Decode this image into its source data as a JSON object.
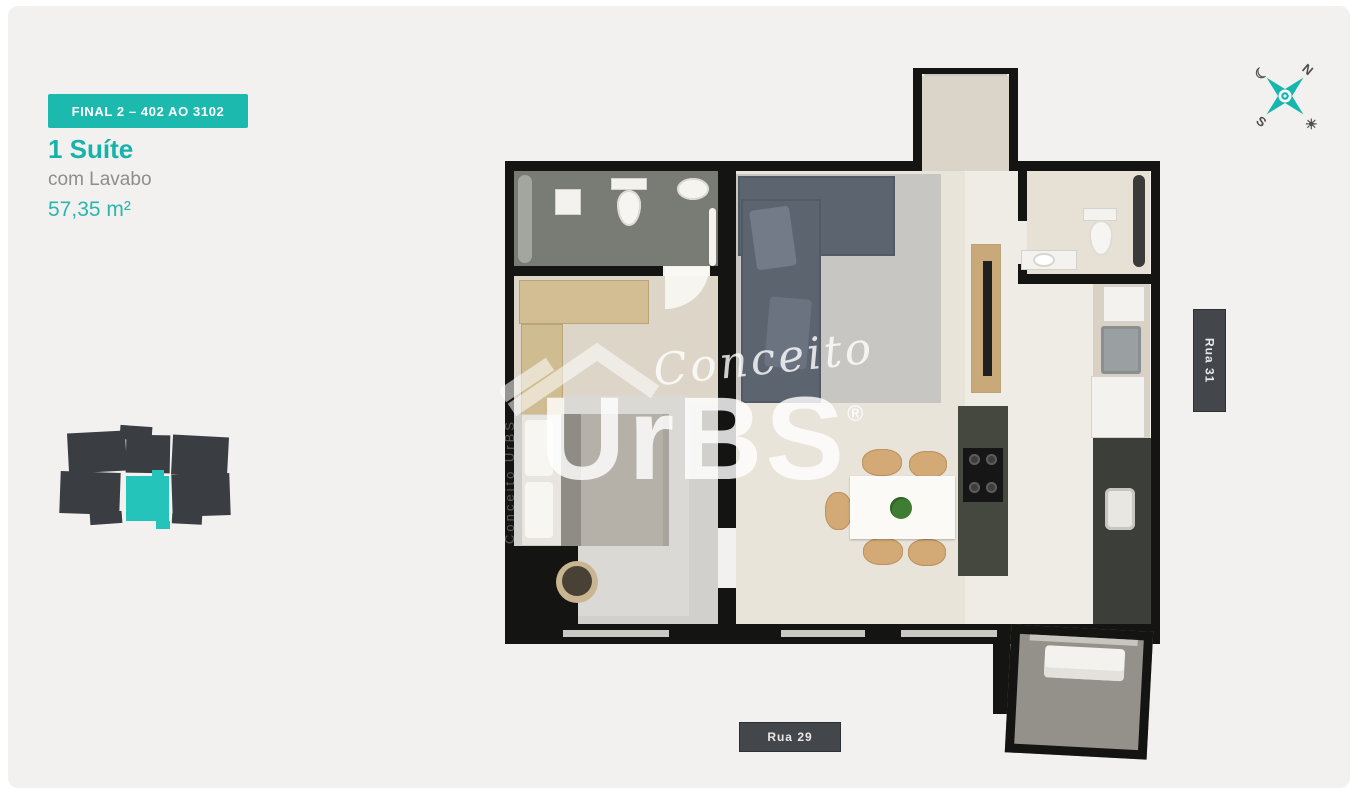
{
  "unit": {
    "badge": "FINAL 2 – 402 AO 3102",
    "title": "1 Suíte",
    "subtitle": "com Lavabo",
    "area": "57,35 m²"
  },
  "streets": {
    "right": "Rua 31",
    "bottom": "Rua 29"
  },
  "compass": {
    "north": "N",
    "south": "S",
    "moon": "☾",
    "sun": "☀"
  },
  "watermark": {
    "script": "Conceito",
    "brand": "UrBS",
    "registered": "®",
    "side": "Conceito UrBS"
  },
  "colors": {
    "background": "#f2f1ef",
    "accent_teal": "#17b3aa",
    "badge_teal": "#1cb9af",
    "street_badge": "#43464a",
    "keyplan_block": "#3a3e43",
    "keyplan_highlight": "#25c4bb",
    "wall": "#141413"
  }
}
